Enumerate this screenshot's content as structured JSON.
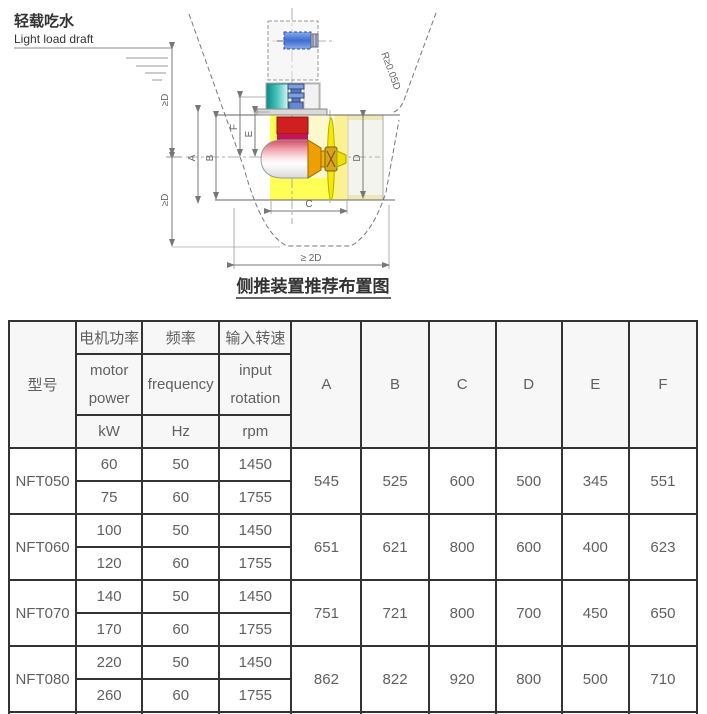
{
  "diagram": {
    "draft_label_cn": "轻载吃水",
    "draft_label_en": "Light load draft",
    "caption": "侧推装置推荐布置图",
    "dim_geq_d_upper": "≥D",
    "dim_geq_d_lower": "≥D",
    "dim_a": "A",
    "dim_b": "B",
    "dim_c": "C",
    "dim_d": "D",
    "dim_e": "E",
    "dim_f": "F",
    "radius_note": "R≥0.05D",
    "bottom_span": "≥ 2D"
  },
  "colors": {
    "motor_blue": "#4a72d2",
    "coupling_teal": "#35b2aa",
    "gearbox_red": "#d01f1f",
    "tunnel_yellow": "#ffff55",
    "propeller_yellow": "#f4ea00",
    "table_border": "#333333",
    "table_header_bg": "#f7f7f7",
    "text_gray": "#606060"
  },
  "table": {
    "header": {
      "model": "型号",
      "power_cn": "电机功率",
      "power_en1": "motor",
      "power_en2": "power",
      "power_unit": "kW",
      "freq_cn": "频率",
      "freq_en": "frequency",
      "freq_unit": "Hz",
      "speed_cn": "输入转速",
      "speed_en1": "input",
      "speed_en2": "rotation",
      "speed_unit": "rpm",
      "dims": [
        "A",
        "B",
        "C",
        "D",
        "E",
        "F"
      ]
    },
    "rows": [
      {
        "model": "NFT050",
        "variants": [
          {
            "power": "60",
            "freq": "50",
            "rpm": "1450"
          },
          {
            "power": "75",
            "freq": "60",
            "rpm": "1755"
          }
        ],
        "A": "545",
        "B": "525",
        "C": "600",
        "D": "500",
        "E": "345",
        "F": "551"
      },
      {
        "model": "NFT060",
        "variants": [
          {
            "power": "100",
            "freq": "50",
            "rpm": "1450"
          },
          {
            "power": "120",
            "freq": "60",
            "rpm": "1755"
          }
        ],
        "A": "651",
        "B": "621",
        "C": "800",
        "D": "600",
        "E": "400",
        "F": "623"
      },
      {
        "model": "NFT070",
        "variants": [
          {
            "power": "140",
            "freq": "50",
            "rpm": "1450"
          },
          {
            "power": "170",
            "freq": "60",
            "rpm": "1755"
          }
        ],
        "A": "751",
        "B": "721",
        "C": "800",
        "D": "700",
        "E": "450",
        "F": "650"
      },
      {
        "model": "NFT080",
        "variants": [
          {
            "power": "220",
            "freq": "50",
            "rpm": "1450"
          },
          {
            "power": "260",
            "freq": "60",
            "rpm": "1755"
          }
        ],
        "A": "862",
        "B": "822",
        "C": "920",
        "D": "800",
        "E": "500",
        "F": "710"
      }
    ]
  }
}
